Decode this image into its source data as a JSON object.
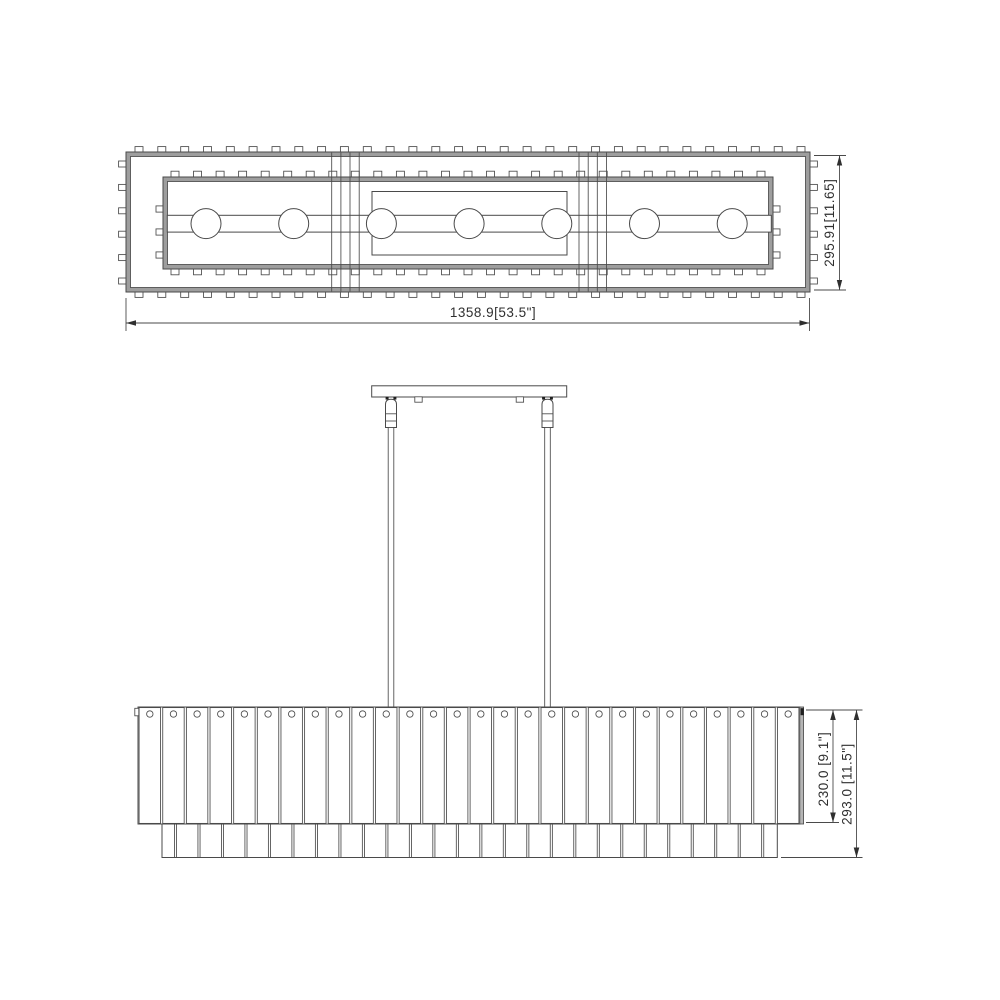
{
  "page": {
    "background_color": "#ffffff",
    "line_color": "#4a4a4a",
    "band_color": "#9e9e9e",
    "text_color": "#2f2f2f"
  },
  "drawing": {
    "type": "technical-dimension-drawing",
    "subject": "linear crystal chandelier",
    "views": [
      "top view",
      "front elevation"
    ]
  },
  "top_view": {
    "width_label": "1358.9[53.5\"]",
    "depth_label": "295.91[11.65]",
    "bulb_count": 7,
    "strap_group_count": 2,
    "strap_lines_per_group": 4,
    "outer_tab_counts": {
      "top": 30,
      "bottom": 30,
      "left": 6,
      "right": 6
    },
    "inner_tab_counts": {
      "top": 27,
      "bottom": 27,
      "left": 3,
      "right": 3
    }
  },
  "front_view": {
    "shade_height_label": "230.0 [9.1\"]",
    "overall_height_label": "293.0 [11.5\"]",
    "hanger_rod_count": 2,
    "canopy_hook_count": 2,
    "upper_slat_count": 28,
    "lower_slat_count": 27
  }
}
